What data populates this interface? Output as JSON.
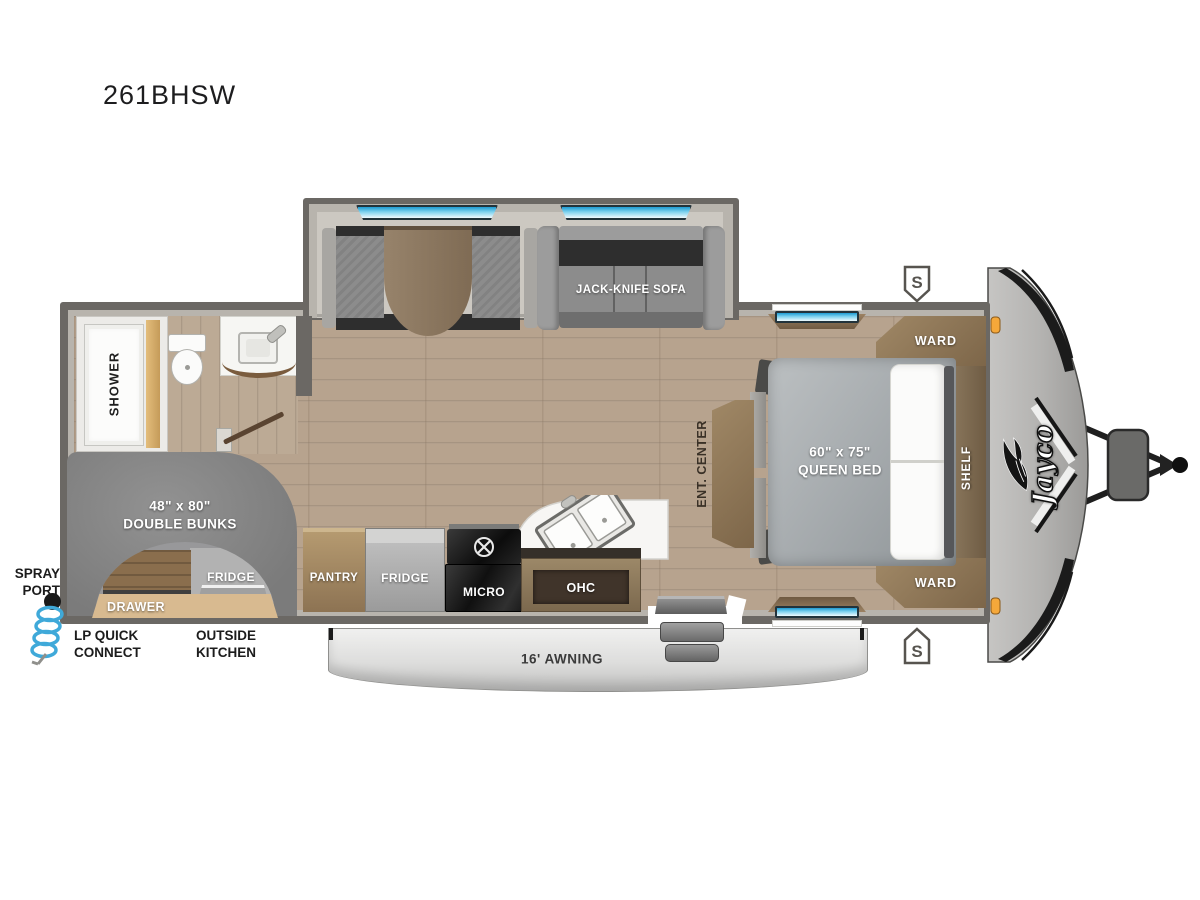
{
  "model": "261BHSW",
  "brand": "Jayco",
  "rooms": {
    "bath": {
      "shower": "SHOWER"
    },
    "bunk": {
      "size": "48\" x 80\"",
      "name": "DOUBLE BUNKS"
    },
    "outside_kitchen": {
      "fridge": "FRIDGE",
      "drawer": "DRAWER",
      "label": [
        "OUTSIDE",
        "KITCHEN"
      ]
    },
    "exterior": {
      "spray_port": [
        "SPRAY",
        "PORT"
      ],
      "lp_quick_connect": [
        "LP QUICK",
        "CONNECT"
      ],
      "awning": "16' AWNING",
      "speaker_top": "S",
      "speaker_bottom": "S"
    },
    "kitchen": {
      "pantry": "PANTRY",
      "fridge": "FRIDGE",
      "micro": "MICRO",
      "ohc": "OHC"
    },
    "living": {
      "sofa": "JACK-KNIFE SOFA"
    },
    "bedroom": {
      "size": "60\" x 75\"",
      "name": "QUEEN BED",
      "ward_top": "WARD",
      "ward_bottom": "WARD",
      "shelf": "SHELF",
      "ent_center": "ENT. CENTER"
    }
  },
  "colors": {
    "wall": "#6b6864",
    "floor_wood": "#b7a38e",
    "slideout_floor": "#ccc8c1",
    "window_blue": "#1e9cd2",
    "awning_gray": "#d6d6d5",
    "clearance_amber": "#f5a83a",
    "cabinet_brown": "#8d7a5f",
    "upholstery_gray": "#8c8c8c",
    "countertop_white": "#f7f6f4"
  }
}
